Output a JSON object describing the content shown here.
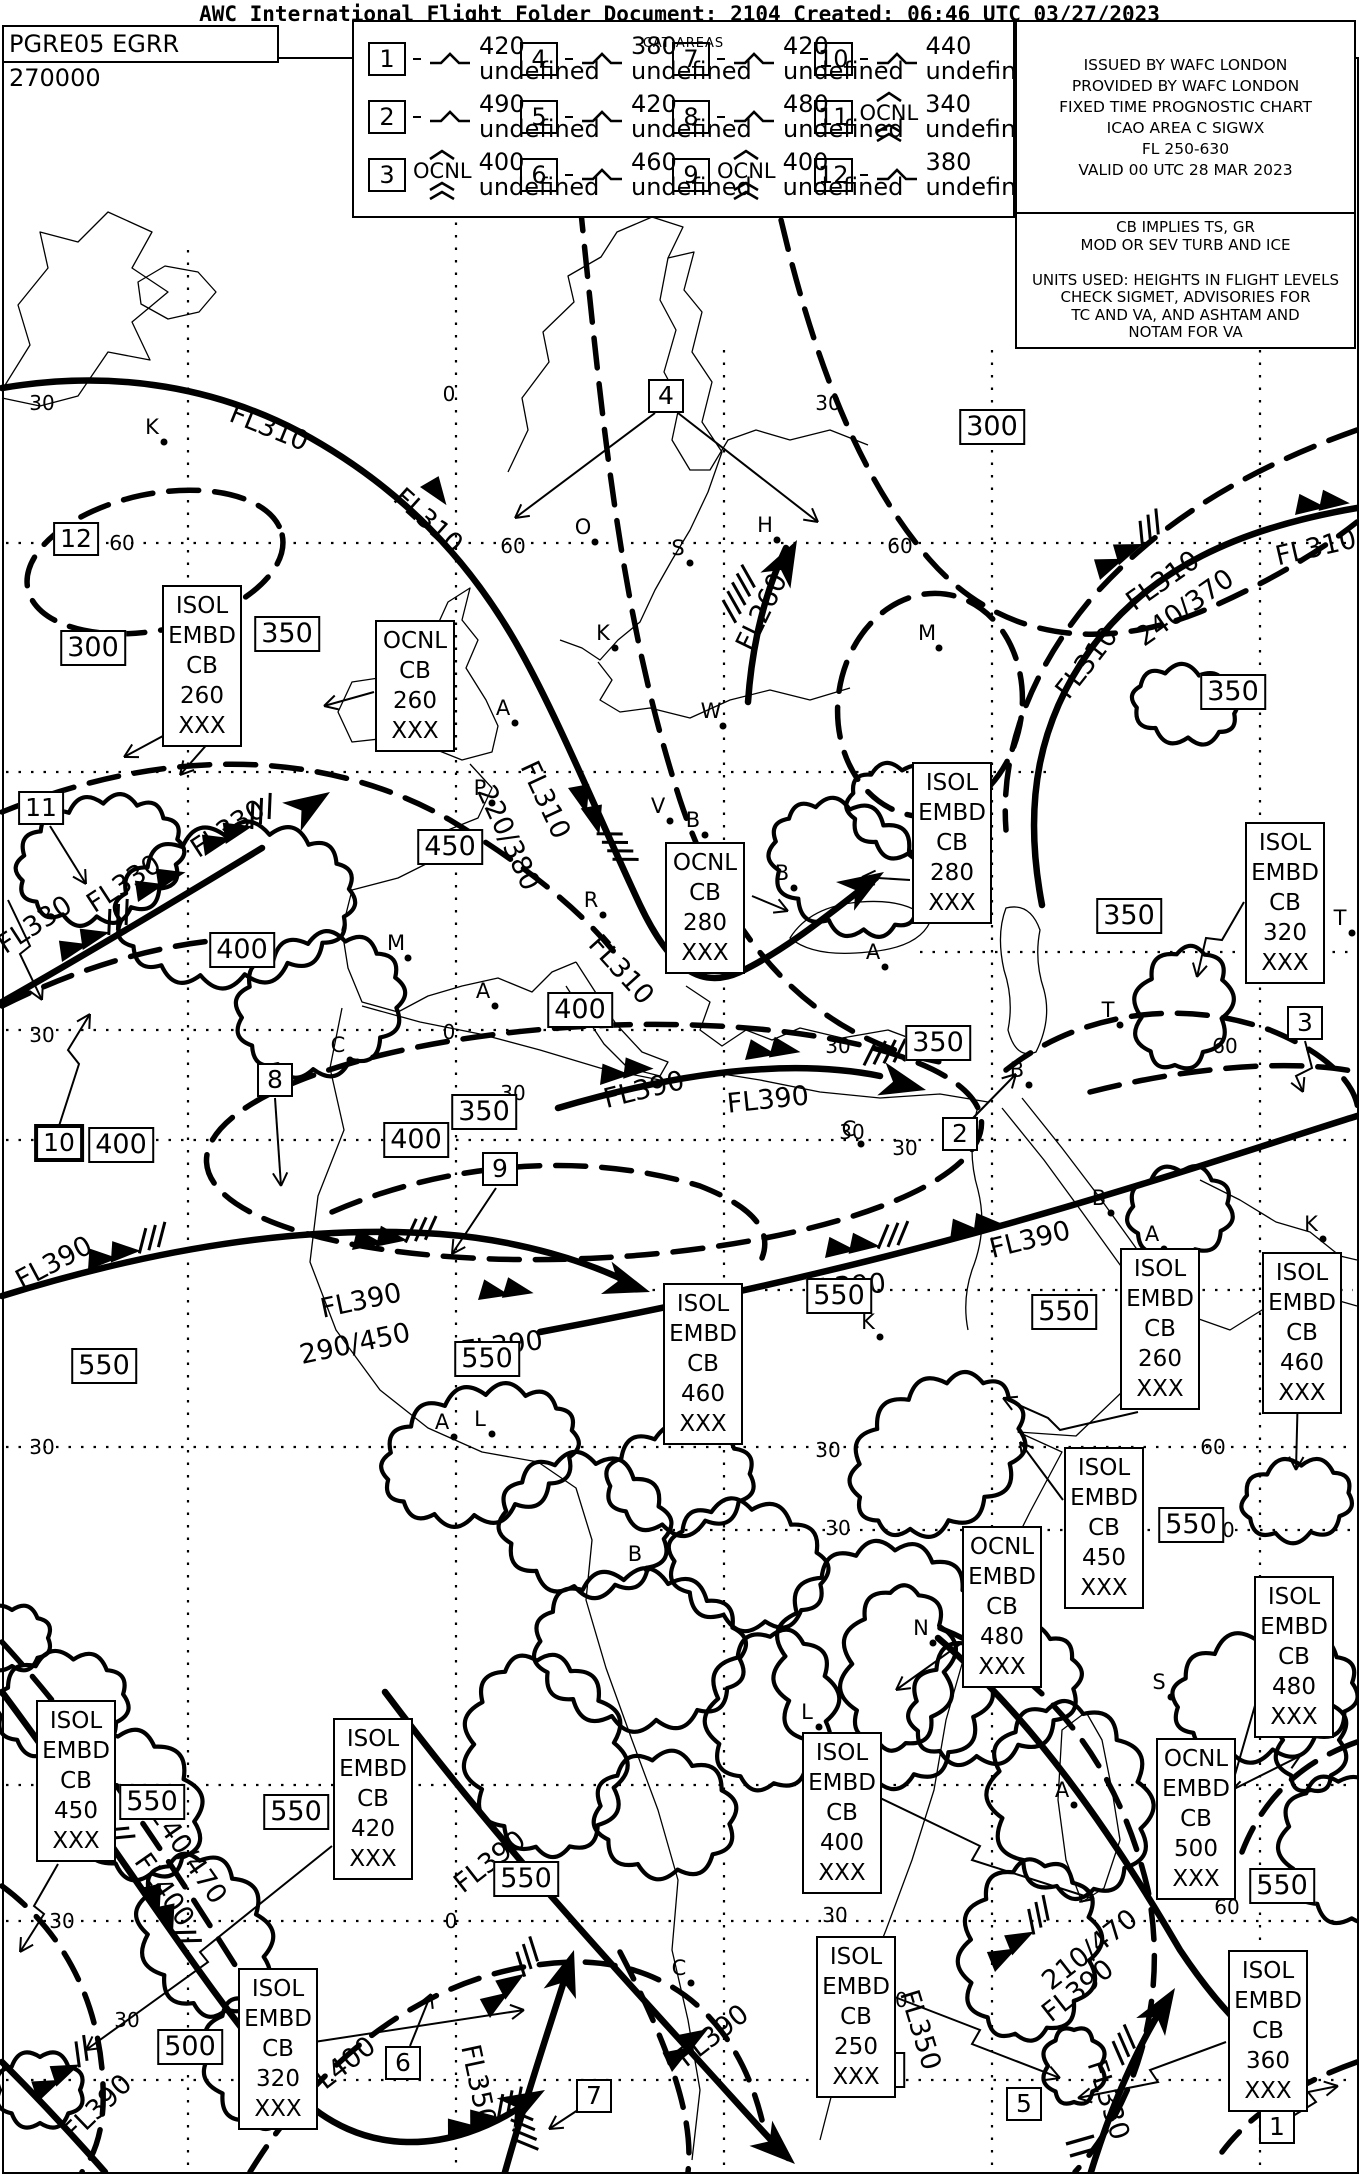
{
  "header": {
    "title": "AWC International Flight Folder Document: 2104 Created: 06:46 UTC 03/27/2023"
  },
  "doc_id": "PGRE05 EGRR 270000",
  "legend": {
    "title": "CAT AREAS",
    "ocnl_label": "OCNL",
    "items": [
      {
        "num": "1",
        "turb": "moderate-turbulence-icon",
        "top": "420",
        "bottom": "XXX"
      },
      {
        "num": "4",
        "turb": "moderate-turbulence-icon",
        "top": "380",
        "bottom": "XXX"
      },
      {
        "num": "7",
        "turb": "moderate-turbulence-icon",
        "top": "420",
        "bottom": "XXX"
      },
      {
        "num": "10",
        "turb": "moderate-turbulence-icon",
        "top": "440",
        "bottom": "XXX"
      },
      {
        "num": "2",
        "turb": "moderate-turbulence-icon",
        "top": "490",
        "bottom": "XXX"
      },
      {
        "num": "5",
        "turb": "moderate-turbulence-icon",
        "top": "420",
        "bottom": "XXX"
      },
      {
        "num": "8",
        "turb": "moderate-turbulence-icon",
        "top": "480",
        "bottom": "XXX"
      },
      {
        "num": "11",
        "turb": "severe-turbulence-ocnl-icon",
        "top": "340",
        "bottom": "250"
      },
      {
        "num": "3",
        "turb": "severe-turbulence-ocnl-icon",
        "top": "400",
        "bottom": "260"
      },
      {
        "num": "6",
        "turb": "moderate-turbulence-icon",
        "top": "460",
        "bottom": "260"
      },
      {
        "num": "9",
        "turb": "severe-turbulence-ocnl-icon",
        "top": "400",
        "bottom": "260"
      },
      {
        "num": "12",
        "turb": "moderate-turbulence-icon",
        "top": "380",
        "bottom": "XXX"
      }
    ]
  },
  "issue_box": {
    "lines": [
      "ISSUED BY WAFC LONDON",
      "PROVIDED BY WAFC LONDON",
      "FIXED TIME PROGNOSTIC CHART",
      "ICAO AREA C SIGWX",
      "FL 250-630",
      "VALID 00 UTC 28 MAR 2023"
    ]
  },
  "notes_box": {
    "lines": [
      "CB IMPLIES TS, GR",
      "MOD OR SEV TURB AND ICE",
      "",
      "UNITS USED: HEIGHTS IN FLIGHT LEVELS",
      "CHECK SIGMET, ADVISORIES FOR",
      "TC AND VA, AND ASHTAM AND",
      "NOTAM FOR VA"
    ]
  },
  "map": {
    "fl_boxes": [
      {
        "label": "300",
        "x": 992,
        "y": 427
      },
      {
        "label": "350",
        "x": 1233,
        "y": 692
      },
      {
        "label": "350",
        "x": 287,
        "y": 634
      },
      {
        "label": "300",
        "x": 93,
        "y": 648
      },
      {
        "label": "450",
        "x": 450,
        "y": 847
      },
      {
        "label": "400",
        "x": 242,
        "y": 950
      },
      {
        "label": "350",
        "x": 1129,
        "y": 916
      },
      {
        "label": "400",
        "x": 580,
        "y": 1010
      },
      {
        "label": "350",
        "x": 938,
        "y": 1043
      },
      {
        "label": "400",
        "x": 121,
        "y": 1145
      },
      {
        "label": "400",
        "x": 416,
        "y": 1140
      },
      {
        "label": "350",
        "x": 484,
        "y": 1112
      },
      {
        "label": "550",
        "x": 839,
        "y": 1296
      },
      {
        "label": "550",
        "x": 1064,
        "y": 1312
      },
      {
        "label": "550",
        "x": 1191,
        "y": 1525
      },
      {
        "label": "550",
        "x": 152,
        "y": 1802
      },
      {
        "label": "550",
        "x": 296,
        "y": 1812
      },
      {
        "label": "550",
        "x": 526,
        "y": 1879
      },
      {
        "label": "500",
        "x": 190,
        "y": 2047
      },
      {
        "label": "450",
        "x": 872,
        "y": 2070
      },
      {
        "label": "550",
        "x": 1282,
        "y": 1886
      },
      {
        "label": "550",
        "x": 104,
        "y": 1366
      },
      {
        "label": "550",
        "x": 487,
        "y": 1359
      }
    ],
    "area_numbers": [
      {
        "label": "12",
        "x": 76,
        "y": 539,
        "bold": false
      },
      {
        "label": "11",
        "x": 41,
        "y": 808,
        "bold": false
      },
      {
        "label": "10",
        "x": 59,
        "y": 1143,
        "bold": true
      },
      {
        "label": "8",
        "x": 275,
        "y": 1080,
        "bold": false
      },
      {
        "label": "9",
        "x": 500,
        "y": 1169,
        "bold": false
      },
      {
        "label": "2",
        "x": 960,
        "y": 1134,
        "bold": false
      },
      {
        "label": "3",
        "x": 1305,
        "y": 1023,
        "bold": false
      },
      {
        "label": "4",
        "x": 666,
        "y": 396,
        "bold": false
      },
      {
        "label": "6",
        "x": 403,
        "y": 2063,
        "bold": false
      },
      {
        "label": "7",
        "x": 594,
        "y": 2096,
        "bold": false
      },
      {
        "label": "5",
        "x": 1024,
        "y": 2104,
        "bold": false
      },
      {
        "label": "1",
        "x": 1277,
        "y": 2127,
        "bold": false
      }
    ],
    "cb_boxes": [
      {
        "lines": [
          "ISOL",
          "EMBD",
          "CB",
          "260",
          "XXX"
        ],
        "x": 162,
        "y": 585
      },
      {
        "lines": [
          "OCNL",
          "CB",
          "260",
          "XXX"
        ],
        "x": 375,
        "y": 620
      },
      {
        "lines": [
          "OCNL",
          "CB",
          "280",
          "XXX"
        ],
        "x": 665,
        "y": 842
      },
      {
        "lines": [
          "ISOL",
          "EMBD",
          "CB",
          "280",
          "XXX"
        ],
        "x": 912,
        "y": 762
      },
      {
        "lines": [
          "ISOL",
          "EMBD",
          "CB",
          "320",
          "XXX"
        ],
        "x": 1245,
        "y": 822
      },
      {
        "lines": [
          "ISOL",
          "EMBD",
          "CB",
          "260",
          "XXX"
        ],
        "x": 1120,
        "y": 1248
      },
      {
        "lines": [
          "ISOL",
          "EMBD",
          "CB",
          "460",
          "XXX"
        ],
        "x": 1262,
        "y": 1252
      },
      {
        "lines": [
          "ISOL",
          "EMBD",
          "CB",
          "460",
          "XXX"
        ],
        "x": 663,
        "y": 1283
      },
      {
        "lines": [
          "ISOL",
          "EMBD",
          "CB",
          "450",
          "XXX"
        ],
        "x": 1064,
        "y": 1447
      },
      {
        "lines": [
          "OCNL",
          "EMBD",
          "CB",
          "480",
          "XXX"
        ],
        "x": 962,
        "y": 1526
      },
      {
        "lines": [
          "ISOL",
          "EMBD",
          "CB",
          "480",
          "XXX"
        ],
        "x": 1254,
        "y": 1576
      },
      {
        "lines": [
          "ISOL",
          "EMBD",
          "CB",
          "450",
          "XXX"
        ],
        "x": 36,
        "y": 1700
      },
      {
        "lines": [
          "ISOL",
          "EMBD",
          "CB",
          "420",
          "XXX"
        ],
        "x": 333,
        "y": 1718
      },
      {
        "lines": [
          "ISOL",
          "EMBD",
          "CB",
          "320",
          "XXX"
        ],
        "x": 238,
        "y": 1968
      },
      {
        "lines": [
          "ISOL",
          "EMBD",
          "CB",
          "400",
          "XXX"
        ],
        "x": 802,
        "y": 1732
      },
      {
        "lines": [
          "OCNL",
          "EMBD",
          "CB",
          "500",
          "XXX"
        ],
        "x": 1156,
        "y": 1738
      },
      {
        "lines": [
          "ISOL",
          "EMBD",
          "CB",
          "250",
          "XXX"
        ],
        "x": 816,
        "y": 1936
      },
      {
        "lines": [
          "ISOL",
          "EMBD",
          "CB",
          "360",
          "XXX"
        ],
        "x": 1228,
        "y": 1950
      }
    ],
    "jet_labels": [
      {
        "text": "FL310",
        "x": 269,
        "y": 428,
        "rot": 22
      },
      {
        "text": "FL310",
        "x": 428,
        "y": 521,
        "rot": 42
      },
      {
        "text": "FL310",
        "x": 545,
        "y": 800,
        "rot": 65
      },
      {
        "text": "220/380",
        "x": 508,
        "y": 838,
        "rot": 65
      },
      {
        "text": "FL310",
        "x": 621,
        "y": 970,
        "rot": 48
      },
      {
        "text": "FL260",
        "x": 762,
        "y": 612,
        "rot": -64
      },
      {
        "text": "FL310",
        "x": 1087,
        "y": 663,
        "rot": -52
      },
      {
        "text": "FL310",
        "x": 1163,
        "y": 581,
        "rot": -35
      },
      {
        "text": "240/370",
        "x": 1185,
        "y": 608,
        "rot": -35
      },
      {
        "text": "FL310",
        "x": 1316,
        "y": 548,
        "rot": -13
      },
      {
        "text": "FL330",
        "x": 228,
        "y": 829,
        "rot": -33
      },
      {
        "text": "FL330",
        "x": 124,
        "y": 884,
        "rot": -33
      },
      {
        "text": "FL330",
        "x": 35,
        "y": 925,
        "rot": -33
      },
      {
        "text": "FL390",
        "x": 54,
        "y": 1263,
        "rot": -28
      },
      {
        "text": "FL390",
        "x": 361,
        "y": 1301,
        "rot": -12
      },
      {
        "text": "290/450",
        "x": 355,
        "y": 1344,
        "rot": -12
      },
      {
        "text": "FL390",
        "x": 502,
        "y": 1346,
        "rot": -8
      },
      {
        "text": "FL390",
        "x": 644,
        "y": 1090,
        "rot": -14
      },
      {
        "text": "FL390",
        "x": 768,
        "y": 1100,
        "rot": -6
      },
      {
        "text": "FL390",
        "x": 845,
        "y": 1287,
        "rot": -5
      },
      {
        "text": "FL390",
        "x": 1030,
        "y": 1240,
        "rot": -14
      },
      {
        "text": "240/470",
        "x": 188,
        "y": 1855,
        "rot": 55
      },
      {
        "text": "FL400",
        "x": 164,
        "y": 1890,
        "rot": 55
      },
      {
        "text": "FL400",
        "x": 340,
        "y": 2068,
        "rot": -38
      },
      {
        "text": "FL390",
        "x": 490,
        "y": 1862,
        "rot": -38
      },
      {
        "text": "FL390",
        "x": 713,
        "y": 2036,
        "rot": -38
      },
      {
        "text": "FL350",
        "x": 478,
        "y": 2085,
        "rot": 78
      },
      {
        "text": "FL350",
        "x": 920,
        "y": 2030,
        "rot": 73
      },
      {
        "text": "210/470",
        "x": 1090,
        "y": 1950,
        "rot": -38
      },
      {
        "text": "FL390",
        "x": 1078,
        "y": 1991,
        "rot": -38
      },
      {
        "text": "FL330",
        "x": 1108,
        "y": 2100,
        "rot": 72
      },
      {
        "text": "FL390",
        "x": 98,
        "y": 2108,
        "rot": -44
      }
    ],
    "graticule_labels": [
      {
        "text": "30",
        "x": 42,
        "y": 403
      },
      {
        "text": "0",
        "x": 449,
        "y": 394
      },
      {
        "text": "30",
        "x": 828,
        "y": 403
      },
      {
        "text": "60",
        "x": 122,
        "y": 543
      },
      {
        "text": "60",
        "x": 513,
        "y": 546
      },
      {
        "text": "60",
        "x": 900,
        "y": 546
      },
      {
        "text": "30",
        "x": 42,
        "y": 1035
      },
      {
        "text": "0",
        "x": 449,
        "y": 1032
      },
      {
        "text": "30",
        "x": 513,
        "y": 1093
      },
      {
        "text": "30",
        "x": 838,
        "y": 1046
      },
      {
        "text": "60",
        "x": 1225,
        "y": 1046
      },
      {
        "text": "30",
        "x": 852,
        "y": 1132
      },
      {
        "text": "30",
        "x": 905,
        "y": 1148
      },
      {
        "text": "30",
        "x": 42,
        "y": 1447
      },
      {
        "text": "30",
        "x": 828,
        "y": 1450
      },
      {
        "text": "60",
        "x": 1213,
        "y": 1447
      },
      {
        "text": "30",
        "x": 838,
        "y": 1528
      },
      {
        "text": "60",
        "x": 1222,
        "y": 1530
      },
      {
        "text": "30",
        "x": 62,
        "y": 1921
      },
      {
        "text": "0",
        "x": 451,
        "y": 1921
      },
      {
        "text": "30",
        "x": 127,
        "y": 2020
      },
      {
        "text": "30",
        "x": 835,
        "y": 1915
      },
      {
        "text": "60",
        "x": 1227,
        "y": 1907
      },
      {
        "text": "30",
        "x": 895,
        "y": 2000
      },
      {
        "text": "30",
        "x": 1284,
        "y": 1990
      }
    ],
    "point_labels": [
      {
        "text": "K",
        "x": 152,
        "y": 427
      },
      {
        "text": "O",
        "x": 583,
        "y": 527
      },
      {
        "text": "S",
        "x": 678,
        "y": 548
      },
      {
        "text": "H",
        "x": 765,
        "y": 525
      },
      {
        "text": "M",
        "x": 927,
        "y": 633
      },
      {
        "text": "K",
        "x": 603,
        "y": 633
      },
      {
        "text": "A",
        "x": 503,
        "y": 708
      },
      {
        "text": "L",
        "x": 438,
        "y": 730
      },
      {
        "text": "W",
        "x": 711,
        "y": 711
      },
      {
        "text": "P",
        "x": 480,
        "y": 788
      },
      {
        "text": "V",
        "x": 658,
        "y": 806
      },
      {
        "text": "B",
        "x": 693,
        "y": 820
      },
      {
        "text": "B",
        "x": 782,
        "y": 873
      },
      {
        "text": "R",
        "x": 591,
        "y": 900
      },
      {
        "text": "A",
        "x": 873,
        "y": 952
      },
      {
        "text": "M",
        "x": 396,
        "y": 943
      },
      {
        "text": "A",
        "x": 483,
        "y": 991
      },
      {
        "text": "C",
        "x": 338,
        "y": 1045
      },
      {
        "text": "T",
        "x": 1340,
        "y": 918
      },
      {
        "text": "T",
        "x": 1108,
        "y": 1010
      },
      {
        "text": "B",
        "x": 1017,
        "y": 1070
      },
      {
        "text": "C",
        "x": 849,
        "y": 1129
      },
      {
        "text": "B",
        "x": 1099,
        "y": 1198
      },
      {
        "text": "A",
        "x": 1152,
        "y": 1234
      },
      {
        "text": "K",
        "x": 1311,
        "y": 1224
      },
      {
        "text": "K",
        "x": 868,
        "y": 1322
      },
      {
        "text": "A",
        "x": 442,
        "y": 1422
      },
      {
        "text": "L",
        "x": 480,
        "y": 1419
      },
      {
        "text": "B",
        "x": 635,
        "y": 1554
      },
      {
        "text": "N",
        "x": 921,
        "y": 1628
      },
      {
        "text": "S",
        "x": 1159,
        "y": 1682
      },
      {
        "text": "L",
        "x": 807,
        "y": 1712
      },
      {
        "text": "A",
        "x": 1062,
        "y": 1790
      },
      {
        "text": "C",
        "x": 679,
        "y": 1968
      }
    ]
  }
}
